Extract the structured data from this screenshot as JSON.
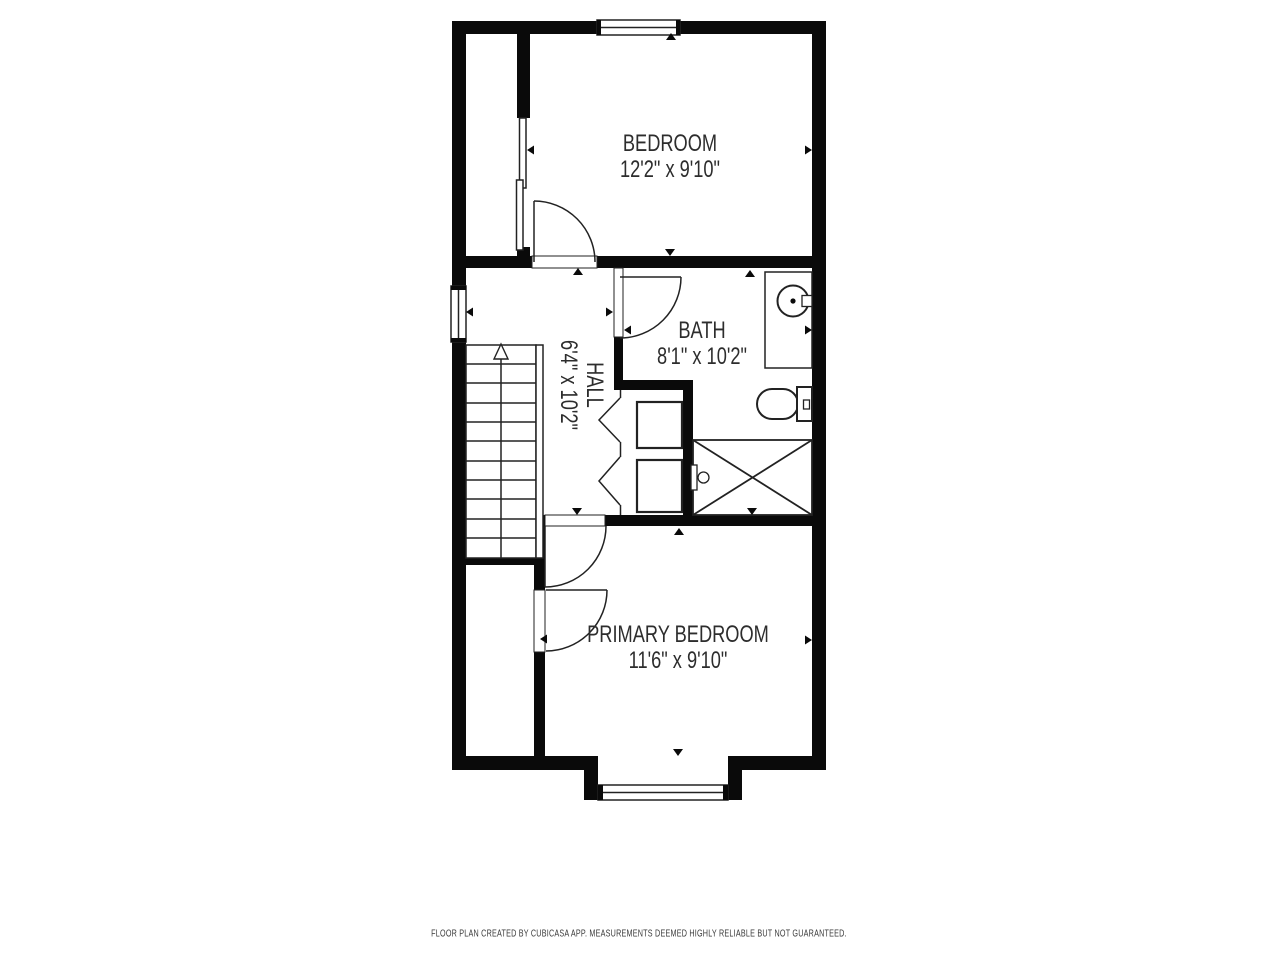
{
  "floor_plan": {
    "rooms": [
      {
        "name": "BEDROOM",
        "dimensions": "12'2\" x 9'10\""
      },
      {
        "name": "HALL",
        "dimensions": "6'4\" x 10'2\""
      },
      {
        "name": "BATH",
        "dimensions": "8'1\" x 10'2\""
      },
      {
        "name": "PRIMARY BEDROOM",
        "dimensions": "11'6\" x 9'10\""
      }
    ],
    "footer": "FLOOR PLAN CREATED BY CUBICASA APP. MEASUREMENTS DEEMED HIGHLY RELIABLE BUT NOT GUARANTEED.",
    "colors": {
      "walls": "#0a0a0a",
      "lines": "#222222",
      "text": "#2d2d2d",
      "background": "#ffffff"
    }
  }
}
